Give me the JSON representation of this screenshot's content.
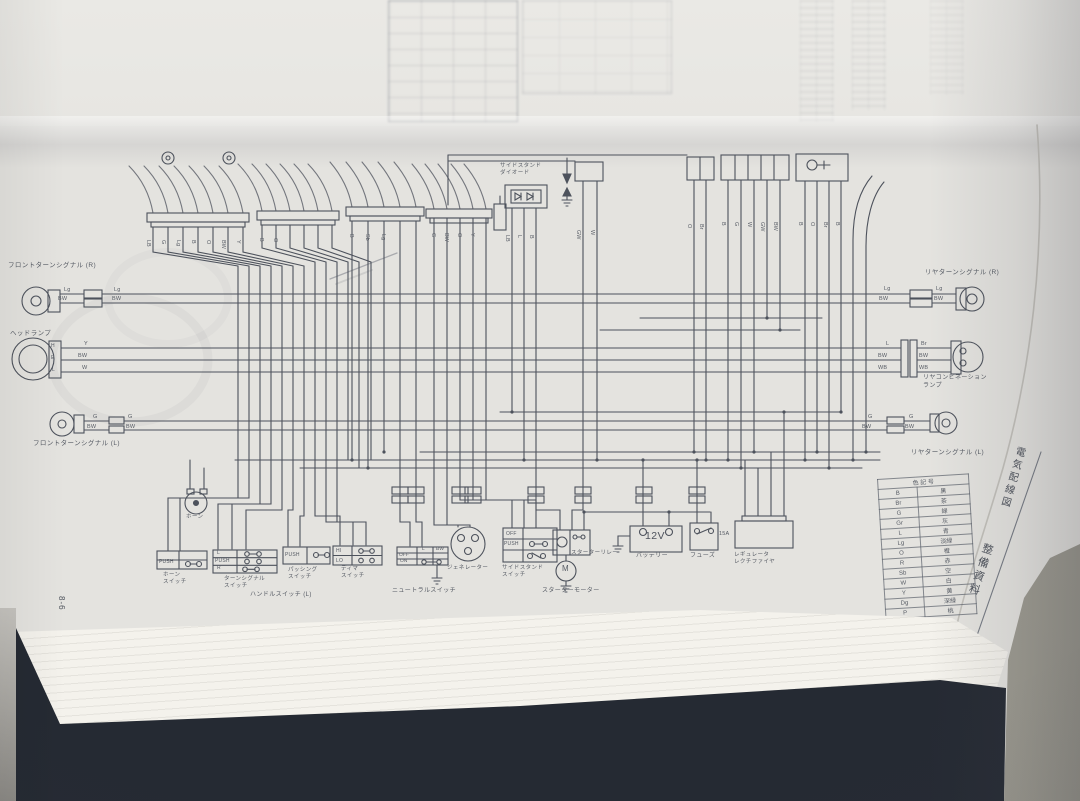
{
  "page": {
    "number": "8-6"
  },
  "tabs": {
    "chapter": "電気配線図",
    "section": "整備資料"
  },
  "labels": {
    "fl_turn_r": "フロントターンシグナル (R)",
    "headlamp": "ヘッドランプ",
    "fl_turn_l": "フロントターンシグナル (L)",
    "rr_turn_r": "リヤターンシグナル (R)",
    "rr_comb": "リヤコンビネーション\nランプ",
    "rr_turn_l": "リヤターンシグナル (L)",
    "horn": "ホーン",
    "horn_sw": "ホーン\nスイッチ",
    "turn_sw": "ターンシグナル\nスイッチ",
    "passing_sw": "パッシング\nスイッチ",
    "dimmer_sw": "ディマ\nスイッチ",
    "handle_sw": "ハンドルスイッチ (L)",
    "neutral_sw": "ニュートラルスイッチ",
    "generator": "ジェネレーター",
    "side_stand_sw": "サイドスタンド\nスイッチ",
    "starter_relay": "スターターリレー",
    "starter_motor": "スターターモーター",
    "battery": "バッテリー",
    "fuse": "フューズ",
    "regulator": "レギュレータ\nレクチファイヤ",
    "ss_diode": "サイドスタンド\nダイオード"
  },
  "values": {
    "battery_voltage": "12V",
    "fuse_rating": "15A",
    "motor": "M",
    "push": "PUSH",
    "hi": "HI",
    "lo": "LO",
    "off": "OFF",
    "on": "ON",
    "l": "L",
    "r": "R",
    "bw": "BW",
    "headlamp_pins": [
      "H",
      "E",
      "L"
    ]
  },
  "wires": {
    "front_r": [
      "Lg",
      "BW"
    ],
    "headlamp": [
      "Y",
      "BW",
      "W"
    ],
    "front_l": [
      "G",
      "BW"
    ],
    "rear_r": [
      "Lg",
      "BW"
    ],
    "rear_comb_left": [
      "L",
      "BW",
      "WB"
    ],
    "rear_comb_right": [
      "Br",
      "BW",
      "WB"
    ],
    "rear_l": [
      "G",
      "BW"
    ],
    "bar1": [
      "LB",
      "G",
      "Lg",
      "B",
      "O",
      "BW",
      "Y"
    ],
    "bar2": [
      "B",
      "O"
    ],
    "bar3": [
      "B",
      "Sb",
      "Lg"
    ],
    "bar4": [
      "G",
      "BW",
      "O",
      "Y"
    ],
    "diode": [
      "LB",
      "L",
      "B"
    ],
    "coil": [
      "GW",
      "W"
    ],
    "box_a": [
      "O",
      "Br"
    ],
    "box_b": [
      "B",
      "G",
      "W",
      "GW",
      "BW"
    ],
    "box_c": [
      "B",
      "O",
      "Br",
      "B"
    ]
  },
  "color_table": {
    "header": "色 記 号",
    "rows": [
      {
        "code": "B",
        "name": "黒"
      },
      {
        "code": "Br",
        "name": "茶"
      },
      {
        "code": "G",
        "name": "緑"
      },
      {
        "code": "Gr",
        "name": "灰"
      },
      {
        "code": "L",
        "name": "青"
      },
      {
        "code": "Lg",
        "name": "淡緑"
      },
      {
        "code": "O",
        "name": "橙"
      },
      {
        "code": "R",
        "name": "赤"
      },
      {
        "code": "Sb",
        "name": "空"
      },
      {
        "code": "W",
        "name": "白"
      },
      {
        "code": "Y",
        "name": "黄"
      },
      {
        "code": "Dg",
        "name": "深緑"
      },
      {
        "code": "P",
        "name": "桃"
      }
    ]
  },
  "colors": {
    "ink": "#4d525c",
    "page": "#e4e3df",
    "base": "#252a33"
  }
}
